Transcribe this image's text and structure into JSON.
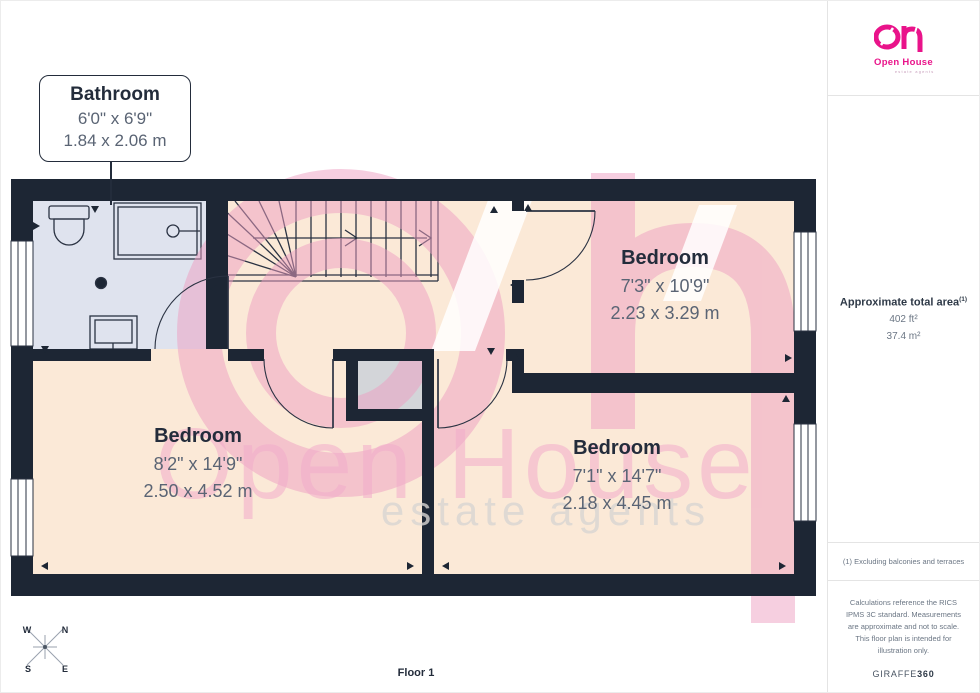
{
  "colors": {
    "wall": "#1d2634",
    "floor": "#fbe9d7",
    "bathroom": "#dfe3ee",
    "alcove": "#d3d5d9",
    "line": "#2a3242",
    "wm-pink": "#ee9fc2",
    "wm-text": "#f2accb",
    "wm-gray": "#d9d6d3",
    "brand-pink": "#e9138a",
    "label": "#232c3b",
    "dim": "#5a6474",
    "muted": "#6b7684",
    "border": "#e4e4e4"
  },
  "callout": {
    "room": "Bathroom",
    "imperial": "6'0\" x 6'9\"",
    "metric": "1.84 x 2.06 m"
  },
  "rooms": [
    {
      "name": "Bedroom",
      "imperial": "7'3\" x 10'9\"",
      "metric": "2.23 x 3.29 m"
    },
    {
      "name": "Bedroom",
      "imperial": "8'2\" x 14'9\"",
      "metric": "2.50 x 4.52 m"
    },
    {
      "name": "Bedroom",
      "imperial": "7'1\" x 14'7\"",
      "metric": "2.18 x 4.45 m"
    }
  ],
  "watermark": {
    "brand": "Open House",
    "tagline": "estate agents"
  },
  "compass": {
    "w": "W",
    "n": "N",
    "s": "S",
    "e": "E"
  },
  "floor_label": "Floor 1",
  "sidebar": {
    "logo": {
      "brand": "Open House",
      "tagline": "estate agents"
    },
    "area": {
      "title": "Approximate total area",
      "note_ref": "(1)",
      "imperial": "402 ft²",
      "metric": "37.4 m²"
    },
    "footnote": "(1) Excluding balconies and terraces",
    "disclaimer": "Calculations reference the RICS IPMS 3C standard. Measurements are approximate and not to scale. This floor plan is intended for illustration only.",
    "generator": {
      "name": "GIRAFFE",
      "suffix": "360"
    }
  }
}
